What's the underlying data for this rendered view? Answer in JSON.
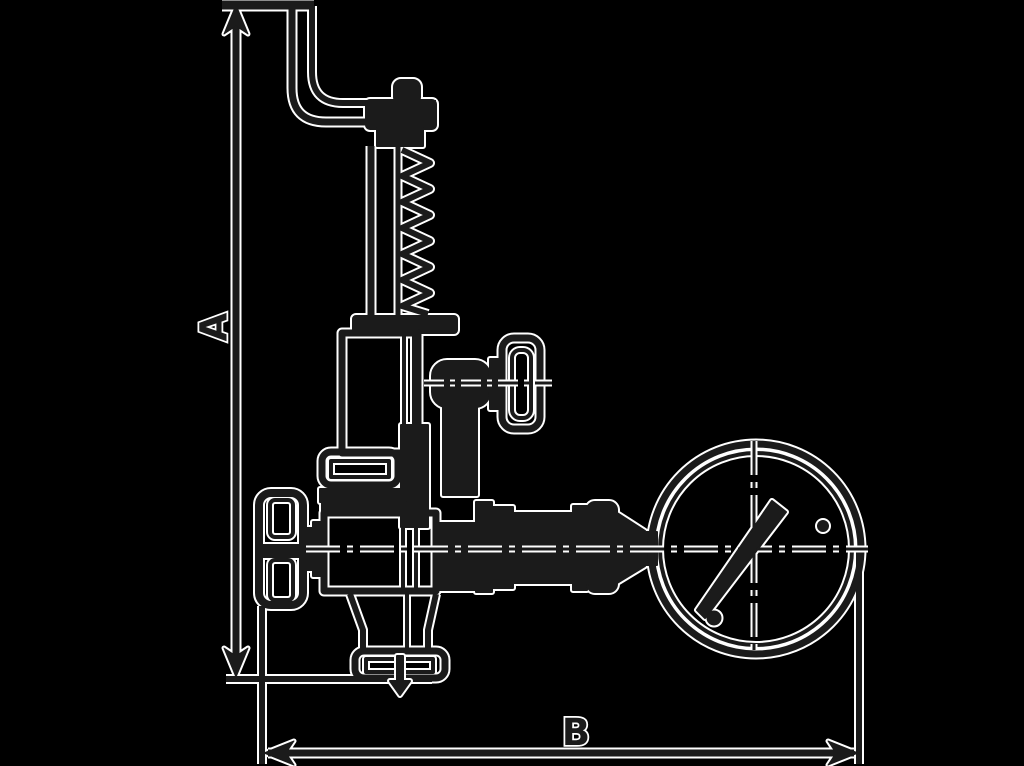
{
  "diagram": {
    "type": "technical-dimension-drawing",
    "subject": "safety relief valve with lifting lever and pressure gauge, outline drawing with overall dimensions",
    "labels": {
      "dim_vertical": "A",
      "dim_horizontal": "B"
    },
    "colors": {
      "background": "#000000",
      "line": "#1b1b1b",
      "halo": "#ffffff"
    }
  }
}
